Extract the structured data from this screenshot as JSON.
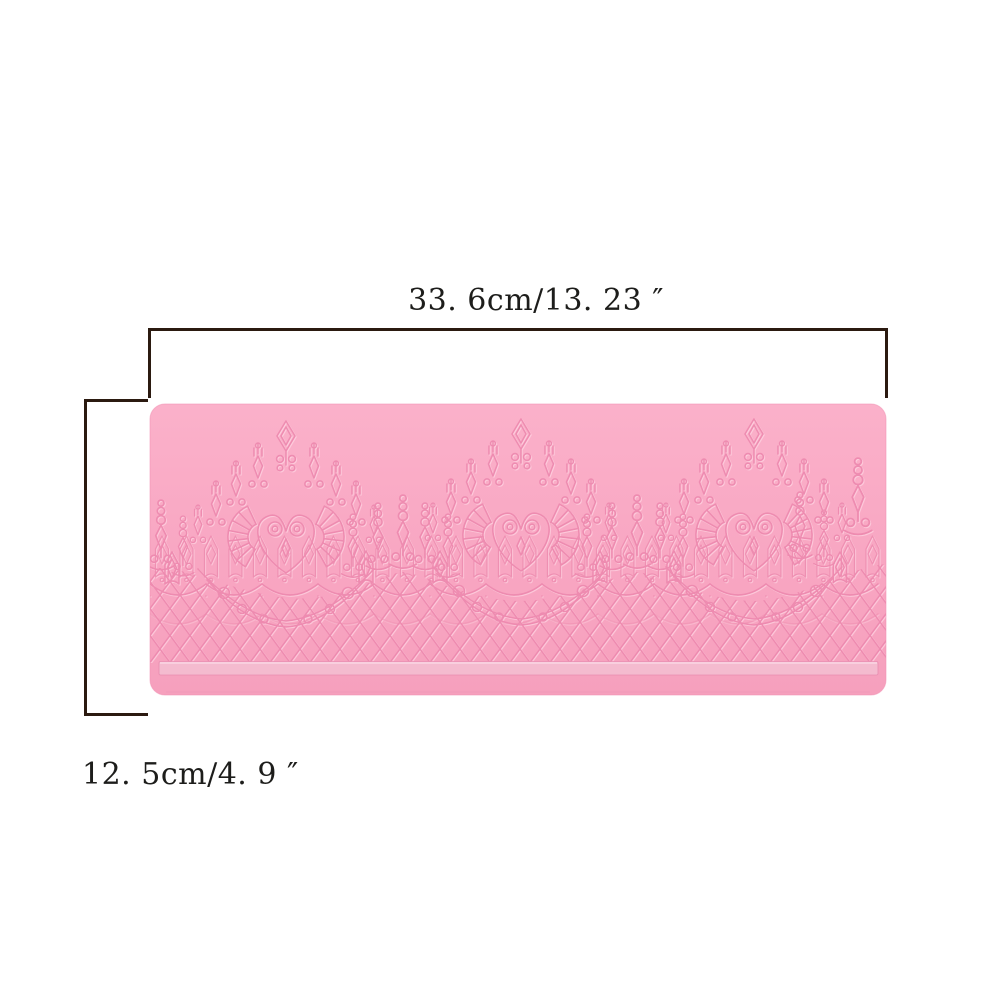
{
  "dimensions": {
    "width_label": "33. 6cm/13. 23 ″",
    "height_label": "12. 5cm/4. 9 ″"
  },
  "product": {
    "description": "pink silicone lace mat with crown motifs and diamond lattice"
  },
  "colors": {
    "background": "#ffffff",
    "mat_pink": "#f8a6c2",
    "mat_pink_light": "#fbb1ca",
    "mat_pink_deep": "#f59fbc",
    "emboss_dark": "#ec86ac",
    "emboss_light": "#ffd9e6",
    "bar_fill": "#f4bdd0",
    "dimension_line": "#2b1a10",
    "label_text": "#1d1d1b"
  }
}
